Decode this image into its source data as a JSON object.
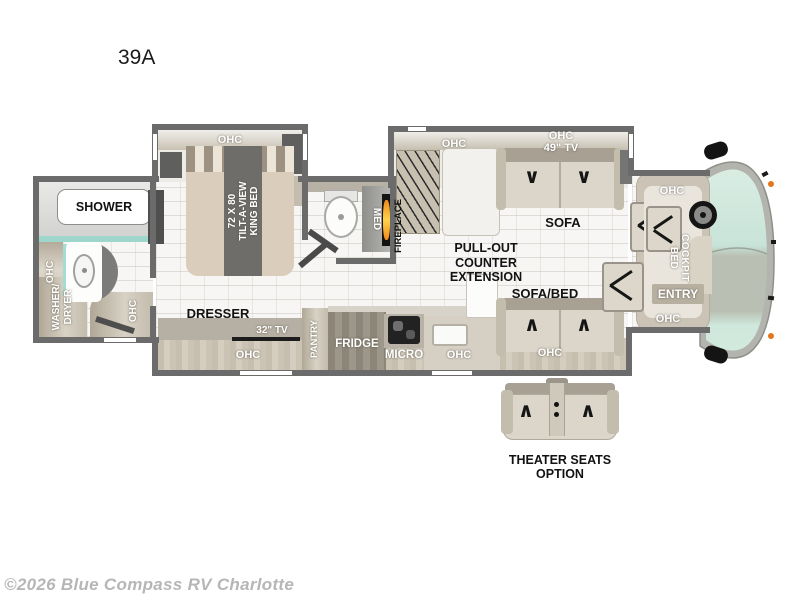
{
  "model_label": "39A",
  "copyright": "©2026 Blue Compass RV Charlotte",
  "labels": {
    "ohc": "OHC",
    "shower": "SHOWER",
    "washer_dryer": [
      "WASHER/",
      "DRYER"
    ],
    "bed": [
      "72 X 80",
      "TILT-A-VIEW",
      "KING BED"
    ],
    "dresser": "DRESSER",
    "tv_32": "32\" TV",
    "pantry": "PANTRY",
    "fridge": "FRIDGE",
    "micro": "MICRO",
    "med": "MED",
    "fireplace": "FIREPLACE",
    "tv_49": "49\" TV",
    "sofa": "SOFA",
    "pullout": [
      "PULL-OUT",
      "COUNTER",
      "EXTENSION"
    ],
    "sofa_bed": "SOFA/BED",
    "cockpit_bed": [
      "COCKPIT",
      "BED"
    ],
    "entry": "ENTRY",
    "theater": [
      "THEATER SEATS",
      "OPTION"
    ]
  },
  "colors": {
    "wall": "#6b6b6b",
    "cabinet_tan": "#c2bbab",
    "glass_teal": "#cde6db",
    "flame_orange": "#f59a23",
    "accent_teal_strip": "#9ed6cc",
    "label_dark": "#121212",
    "label_light": "#ffffff",
    "watermark_gray": "#b6b6b6"
  }
}
